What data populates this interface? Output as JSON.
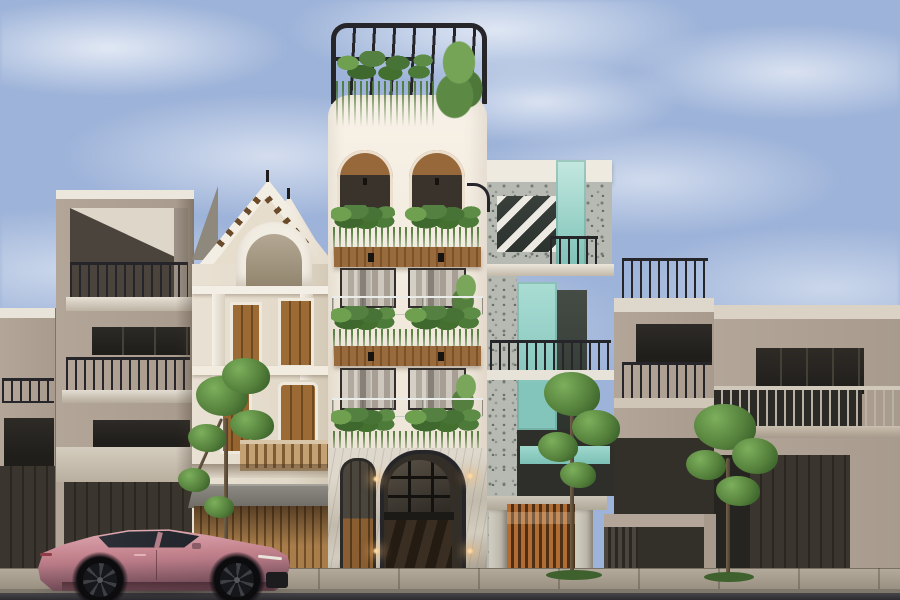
{
  "scene": {
    "type": "architectural-exterior-render",
    "description": "Daytime street-elevation rendering of five adjacent townhouses: a modern taupe house, a classical cream house with double gable pediments, a tall white balcony house with cascading planters and a black rooftop pergola, a terrazzo-and-mint-glass house with diagonal brise-soleil and wooden entry gate, and wide taupe modern houses to the right; slender street trees line the sidewalk and a rose-pink fastback sedan is parked facing right.",
    "time_of_day": "day",
    "weather": "partly-cloudy"
  },
  "palette": {
    "sky": "#9db3d9",
    "cloud_white": "#eef1f7",
    "white_wall": "#f2ebdf",
    "white_wall_shade": "#ddd2c1",
    "wood": "#986a3c",
    "wood_dark": "#5f3f1f",
    "plant": "#55813c",
    "plant_dark": "#3a5f2a",
    "plant_light": "#7fae5f",
    "black_frame": "#26262a",
    "taupe_wall": "#b3a698",
    "taupe_shade": "#9c9083",
    "fascia_white": "#eae5db",
    "window_dark": "#272522",
    "garage_dark": "#35312b",
    "cream_wall": "#e8e0d2",
    "cream_trim": "#f4efe6",
    "terrazzo": "#b6bab3",
    "mint_glass": "#a7dad1",
    "mint_deep": "#7fc3ba",
    "stone_pillar": "#cdc8bd",
    "gate_wood": "#b06c33",
    "sidewalk": "#a29a8d",
    "asphalt": "#39383c",
    "car_pink": "#c48791",
    "car_pink_light": "#e0aab2",
    "car_pink_dark": "#8a5c67",
    "car_glass": "#272a30",
    "sconce_warm": "#f0b66a"
  },
  "objects": {
    "sky": {
      "label": "partly cloudy blue sky"
    },
    "buildings": [
      {
        "id": "far-left-house",
        "label": "edge of modern taupe townhouse with dark railing and garage",
        "floors": 3
      },
      {
        "id": "left-taupe-house",
        "label": "modern taupe townhouse with recessed balconies and dark railings",
        "floors": 3
      },
      {
        "id": "classical-house",
        "label": "classical cream house with double gable, arched niche and wooden doors",
        "floors": 3
      },
      {
        "id": "white-plant-house",
        "label": "tall white house with arched top floor, glass balconies, cascading planters and black rooftop pergola",
        "floors": 5
      },
      {
        "id": "mint-house",
        "label": "terrazzo and mint-glass house with diagonal brise-soleil and wooden slat gate",
        "floors": 4
      },
      {
        "id": "right-taupe-house",
        "label": "modern taupe townhouse with roof-terrace railing",
        "floors": 3
      },
      {
        "id": "far-right-house",
        "label": "wide taupe townhouse with long balcony and dark garage doors",
        "floors": 2
      }
    ],
    "vehicle": {
      "id": "pink-sedan",
      "label": "rose-pink fastback sedan parked facing right"
    },
    "trees": [
      {
        "id": "tree-left",
        "label": "slender street tree in front of classical house"
      },
      {
        "id": "tree-center",
        "label": "street tree in front of wooden entry gate"
      },
      {
        "id": "tree-right",
        "label": "street tree in front of right taupe house"
      }
    ],
    "street": {
      "label": "asphalt street with paved sidewalk and curb"
    }
  }
}
